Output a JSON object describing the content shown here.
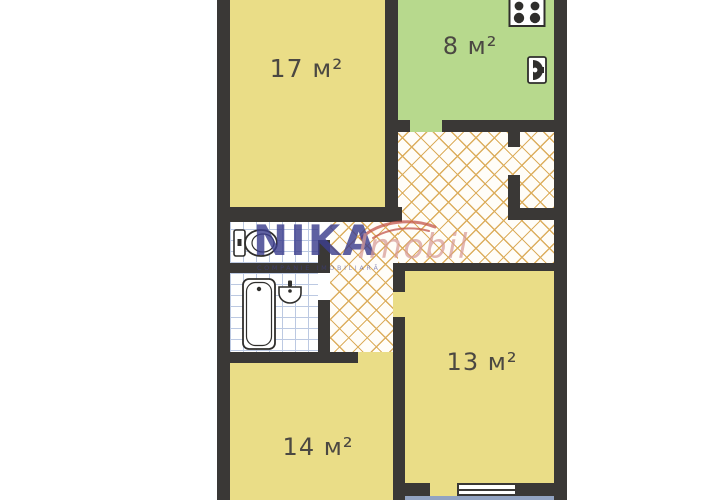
{
  "plan_title": "apartment-floorplan",
  "rooms": [
    {
      "name": "living-room",
      "label": "17 м²",
      "area": 17,
      "unit": "м²"
    },
    {
      "name": "kitchen",
      "label": "8 м²",
      "area": 8,
      "unit": "м²"
    },
    {
      "name": "bedroom-right",
      "label": "13 м²",
      "area": 13,
      "unit": "м²"
    },
    {
      "name": "bedroom-bottom",
      "label": "14 м²",
      "area": 14,
      "unit": "м²"
    }
  ],
  "watermark": {
    "brand": "NIKA",
    "subtext": "COMPANIE IMOBILIARĂ",
    "suffix": "Imobil"
  },
  "fixtures": [
    "stove-icon",
    "kitchen-sink-icon",
    "toilet-icon",
    "bathtub-icon",
    "washbasin-icon",
    "window",
    "balcony"
  ],
  "colors": {
    "bg": "#ffffff",
    "wall": "#3a3836",
    "room-yellow": "#eadd87",
    "kitchen-green": "#b7d98d",
    "balcony-gray": "#92a3c2",
    "tile-line": "#bcc9e2",
    "parquet-line": "#dcae5e",
    "label": "#4b4842",
    "brand-navy": "#3d3f8e",
    "brand-red": "#d89b96",
    "swoosh-red": "#c4564b",
    "fixture-stroke": "#2f2e2c"
  }
}
